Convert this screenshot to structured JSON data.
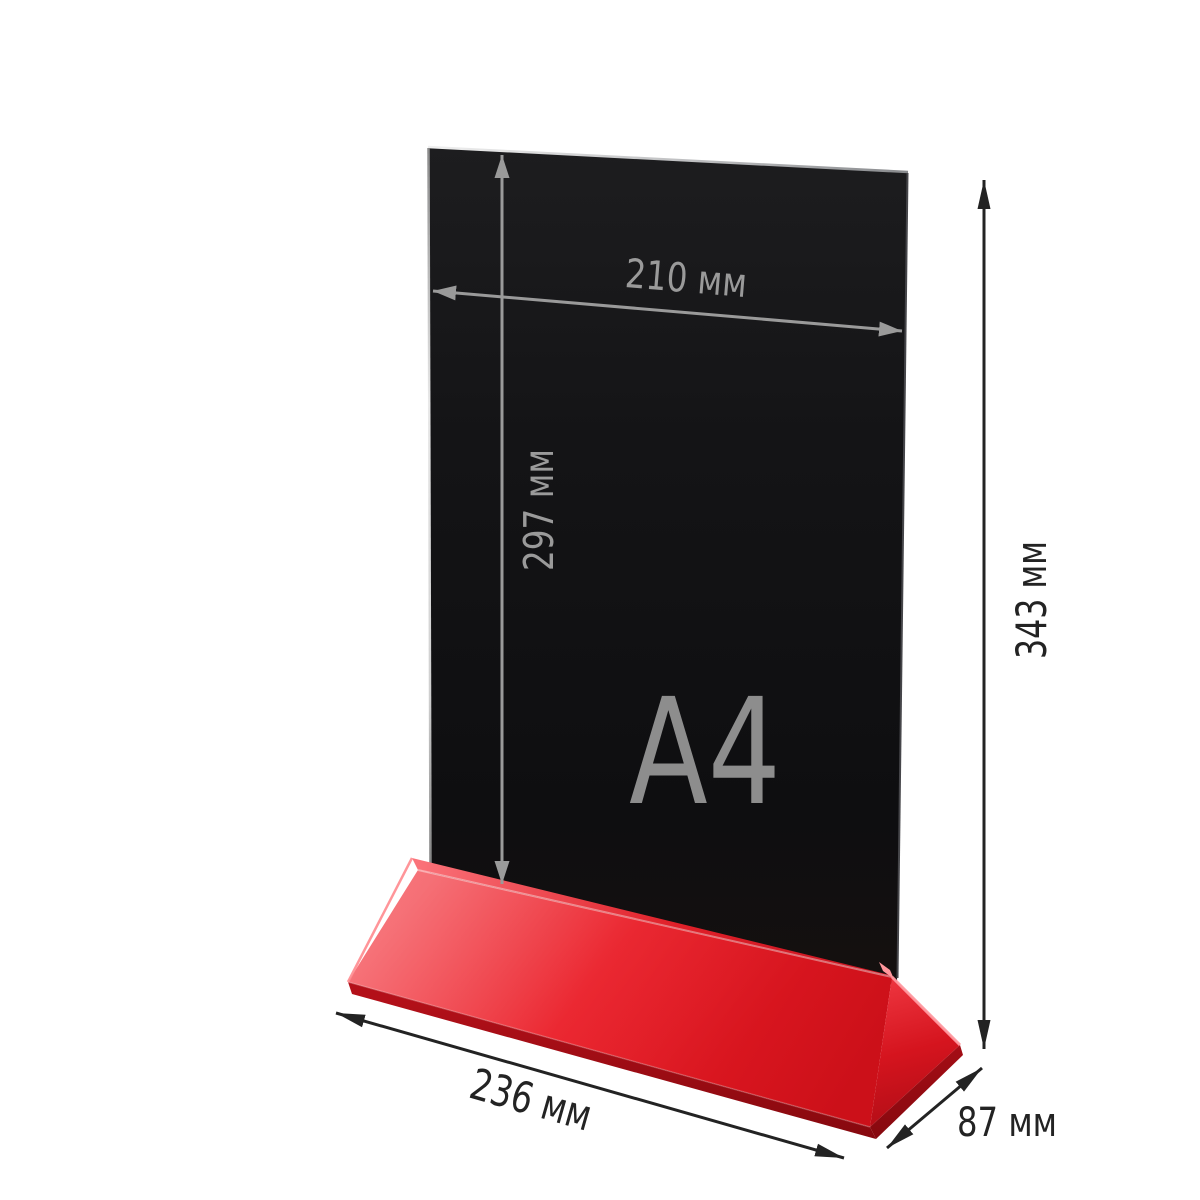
{
  "product": {
    "format_label": "A4",
    "description": "table tent / menu holder with black A4 insert panel and red base"
  },
  "labels": {
    "format": "A4",
    "insert_width": "210 мм",
    "insert_height": "297 мм",
    "total_height": "343 мм",
    "base_length": "236 мм",
    "base_depth": "87 мм"
  },
  "colors": {
    "background": "#ffffff",
    "panel_black": "#131315",
    "base_red": "#e91e28",
    "base_red_dark": "#b00d16",
    "bevel_pink": "#ff99a0",
    "dimension_gray": "#9a9a9a",
    "dimension_dark": "#232323",
    "format_text_gray": "#8d8d8d"
  }
}
